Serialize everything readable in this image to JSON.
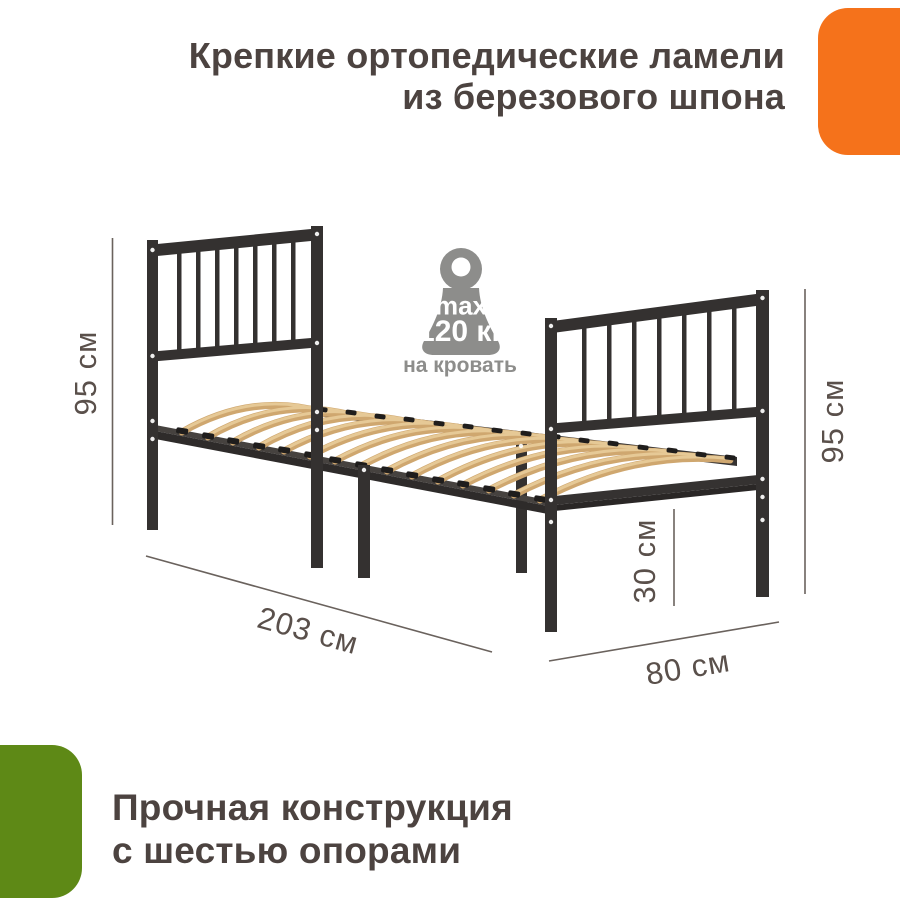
{
  "top_banner": {
    "line1": "Крепкие ортопедические ламели",
    "line2": "из березового шпона"
  },
  "bottom_banner": {
    "line1": "Прочная конструкция",
    "line2": "с шестью опорами"
  },
  "weight_badge": {
    "max_label": "max",
    "value": "120 кг",
    "caption": "на кровать"
  },
  "dimensions": {
    "headboard_height": "95 см",
    "footboard_height": "95 см",
    "frame_clearance": "30 см",
    "length": "203 см",
    "width": "80 см"
  },
  "icons": {
    "weight_icon": "kettlebell-weight"
  },
  "colors": {
    "accent_orange": "#f5721b",
    "accent_green": "#5e8916",
    "heading_text": "#4c4340",
    "dimension_text": "#5a504b",
    "dimension_line": "#6a625d",
    "icon_gray": "#8d8d8b",
    "metal_frame": "#343130",
    "slat_wood": "#d2a971",
    "slat_wood_light": "#e6c996"
  }
}
